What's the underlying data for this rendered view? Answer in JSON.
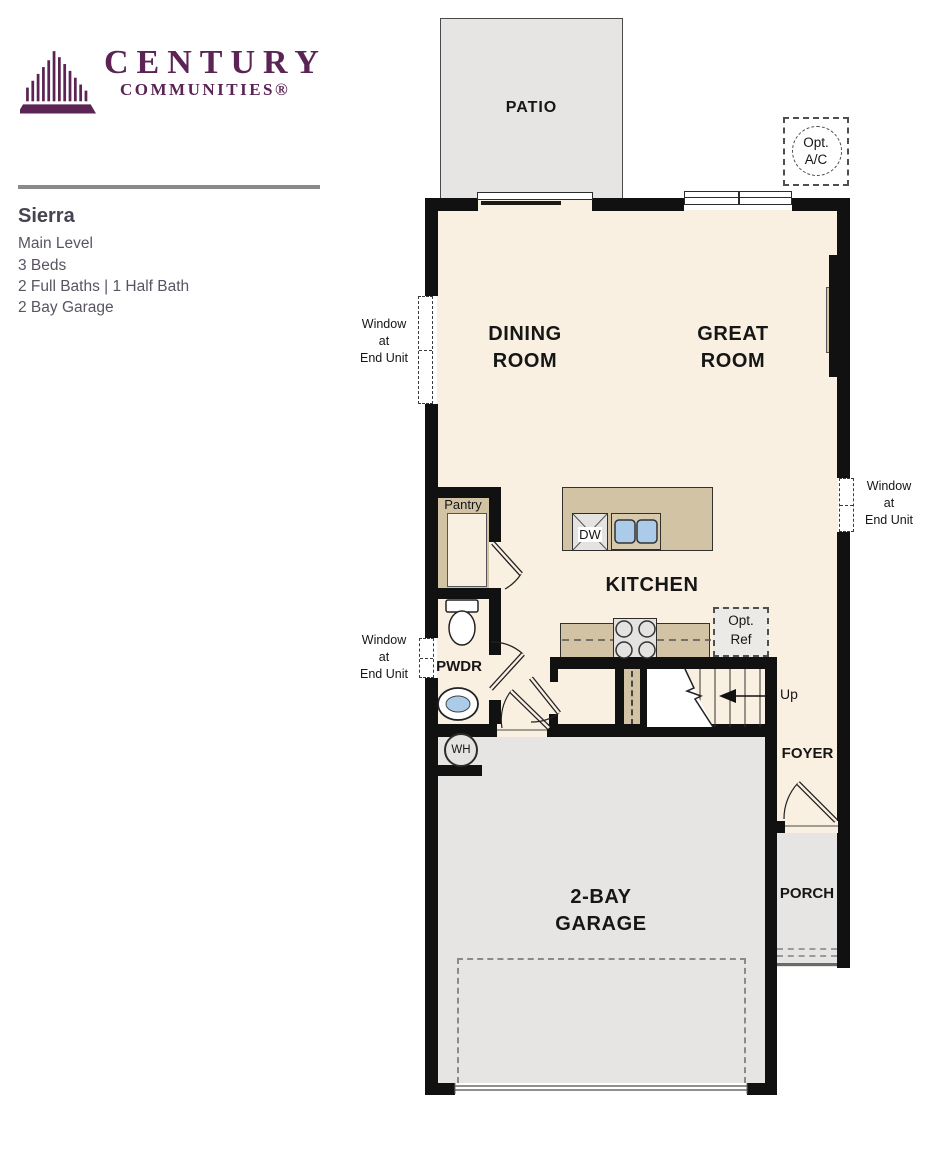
{
  "brand": {
    "name_line1": "CENTURY",
    "name_line2": "COMMUNITIES®",
    "color": "#5b2455"
  },
  "plan": {
    "name": "Sierra",
    "level": "Main Level",
    "beds": "3 Beds",
    "baths": "2 Full Baths | 1 Half Bath",
    "garage": "2 Bay Garage"
  },
  "floorplan": {
    "labels": {
      "patio": "PATIO",
      "dining": [
        "DINING",
        "ROOM"
      ],
      "great": [
        "GREAT",
        "ROOM"
      ],
      "kitchen": "KITCHEN",
      "garage": [
        "2-BAY",
        "GARAGE"
      ],
      "foyer": "FOYER",
      "porch": "PORCH",
      "pwdr": "PWDR",
      "pantry": "Pantry",
      "dw": "DW",
      "wh": "WH",
      "up": "Up",
      "opt_ac": [
        "Opt.",
        "A/C"
      ],
      "opt_ref": [
        "Opt.",
        "Ref"
      ],
      "window_note": [
        "Window",
        "at",
        "End Unit"
      ]
    },
    "colors": {
      "wall": "#111111",
      "floor": "#faf0e2",
      "outdoor": "#e6e5e3",
      "counter": "#d2c3a5",
      "fixture_water": "#abcbe8",
      "brand_purple": "#5b2455"
    }
  }
}
